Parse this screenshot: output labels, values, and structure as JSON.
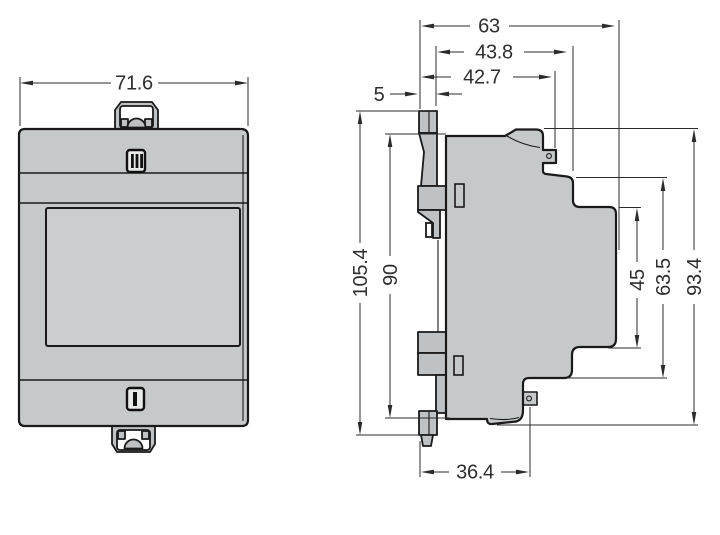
{
  "views": {
    "front": {
      "width": "71.6"
    },
    "side": {
      "overall_depth": "63",
      "upper_body_depth": "43.8",
      "latch_depth": "42.7",
      "rear_tab_depth": "5",
      "total_height_with_clip": "105.4",
      "body_height": "90",
      "front_section_height": "45",
      "mid_section_height": "63.5",
      "overall_height": "93.4",
      "base_depth": "36.4"
    }
  },
  "colors": {
    "background": "#ffffff",
    "body_fill": "#c6c9ca",
    "panel_fill": "#cbcecf",
    "outline": "#1a1a1a",
    "dimension": "#2b2b2b"
  }
}
